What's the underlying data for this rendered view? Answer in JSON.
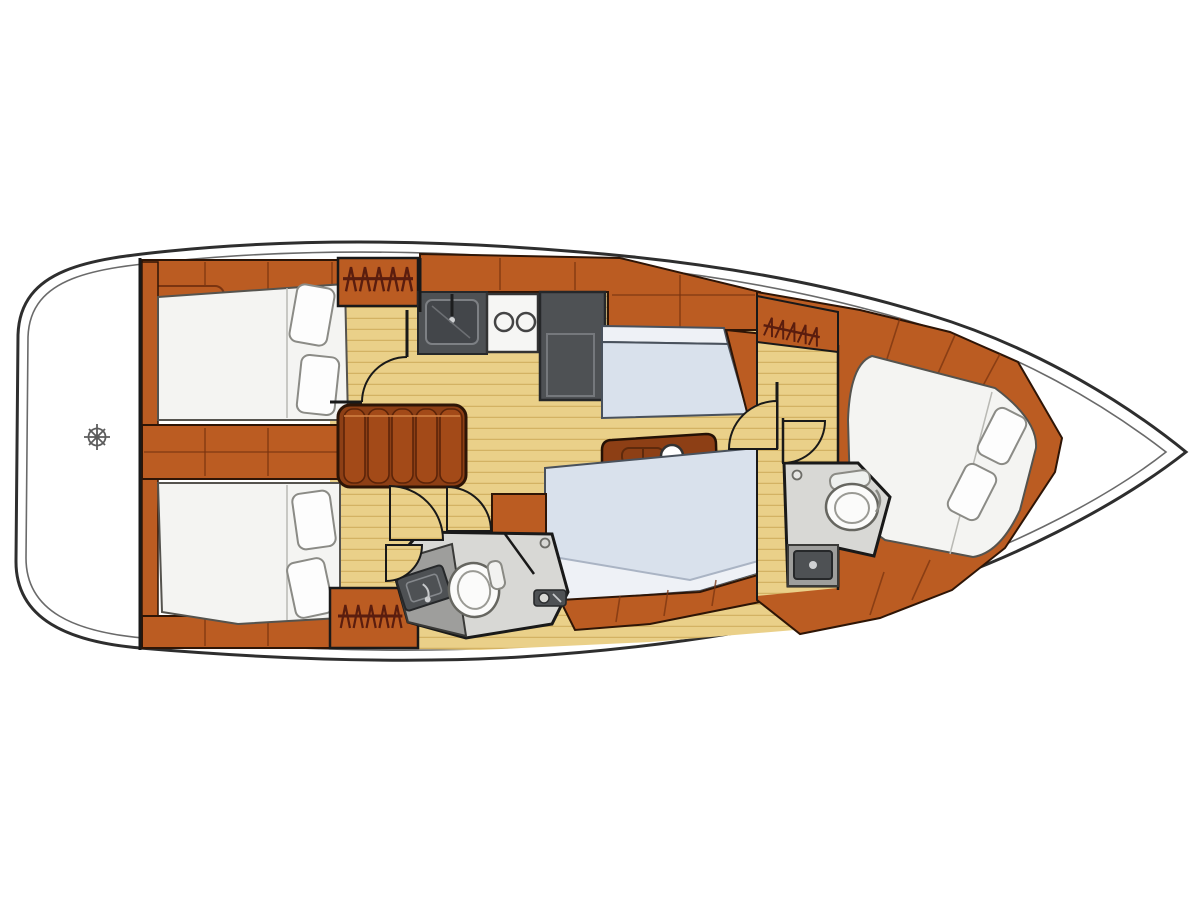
{
  "title": "Sailboat interior layout plan, top-down view, bow pointing right",
  "diagram_type": "yacht-floorplan",
  "areas": [
    {
      "name": "stern-platform",
      "features": [
        "helm-wheel-symbol"
      ]
    },
    {
      "name": "aft-cabin-port",
      "features": [
        "double-berth",
        "two-pillows",
        "hanging-locker",
        "cabinet-drawer"
      ]
    },
    {
      "name": "aft-cabin-starboard",
      "features": [
        "double-berth",
        "two-pillows",
        "hanging-locker"
      ]
    },
    {
      "name": "companionway",
      "features": [
        "steps"
      ]
    },
    {
      "name": "galley",
      "features": [
        "sink",
        "two-burner-stove",
        "refrigerator"
      ]
    },
    {
      "name": "salon",
      "features": [
        "port-settee",
        "dining-table",
        "table-knob",
        "long-starboard-settee",
        "side-cabinet"
      ]
    },
    {
      "name": "aft-head",
      "features": [
        "toilet",
        "washbasin",
        "shower-partition",
        "shower-mixer"
      ]
    },
    {
      "name": "forward-head",
      "features": [
        "toilet",
        "washbasin"
      ]
    },
    {
      "name": "forward-cabin",
      "features": [
        "double-v-berth",
        "two-pillows",
        "hanging-locker",
        "shelving"
      ]
    },
    {
      "name": "bow-deck",
      "features": []
    }
  ],
  "colors": {
    "hull_stroke": "#2e2e2e",
    "hull_inner": "#6a6a6a",
    "wall": "#191919",
    "wood_mid": "#bb5c22",
    "wood_dark": "#8d3f15",
    "wood_edge": "#2e1506",
    "wood_line": "#7a3410",
    "steps_wood": "#a34a18",
    "floor_light": "#ead089",
    "floor_line": "#d3b263",
    "mattress": "#f4f4f2",
    "mattress_stroke": "#55534e",
    "pillow": "#fdfdfd",
    "pillow_stroke": "#8b8b86",
    "settee": "#d9e1ec",
    "settee_light": "#eef1f6",
    "settee_stroke": "#49515c",
    "head_floor": "#d8d8d5",
    "head_floor_dark": "#9e9e9c",
    "fixture_dark": "#4e5154",
    "fixture_stroke": "#26282a",
    "toilet_white": "#fbfbfa",
    "toilet_stroke": "#666660",
    "stove_white": "#f6f6f4",
    "hanger": "#5a1d0e",
    "helm": "#5c5c5c"
  }
}
